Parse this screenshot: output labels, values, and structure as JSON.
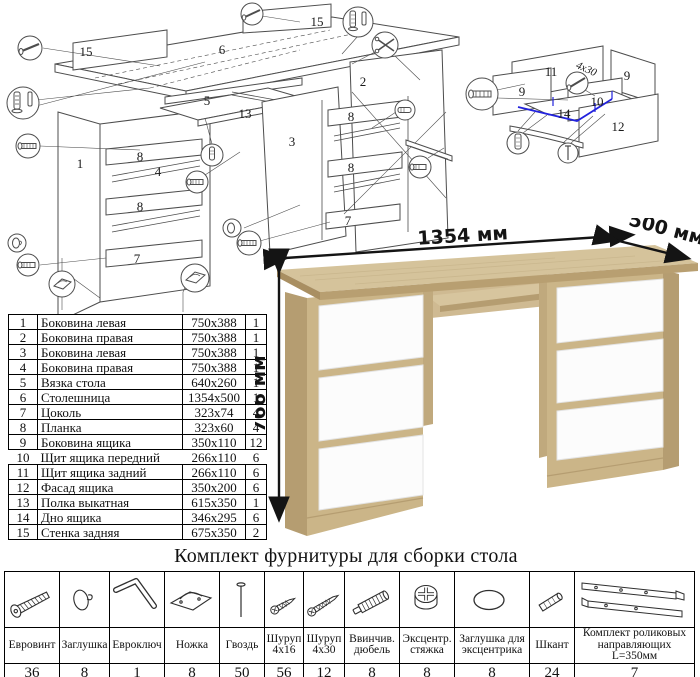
{
  "exploded": {
    "labels": [
      "15",
      "6",
      "15",
      "1",
      "8",
      "4",
      "8",
      "7",
      "5",
      "13",
      "3",
      "2",
      "8",
      "8",
      "7"
    ]
  },
  "drawer": {
    "labels": [
      "11",
      "9",
      "9",
      "10",
      "14",
      "12"
    ],
    "screw_note": "4x30",
    "highlight_color": "#2222dd"
  },
  "desk": {
    "dims": {
      "width": "1354 мм",
      "depth": "500 мм",
      "height": "766 мм"
    },
    "colors": {
      "oak_top": "#d5c39b",
      "oak_front": "#cbb588",
      "oak_side": "#b59d71",
      "drawer_white": "#fcfcfc"
    }
  },
  "parts_table": {
    "rows": [
      {
        "num": "1",
        "name": "Боковина левая",
        "size": "750x388",
        "qty": "1"
      },
      {
        "num": "2",
        "name": "Боковина правая",
        "size": "750x388",
        "qty": "1"
      },
      {
        "num": "3",
        "name": "Боковина левая",
        "size": "750x388",
        "qty": "1"
      },
      {
        "num": "4",
        "name": "Боковина правая",
        "size": "750x388",
        "qty": "1"
      },
      {
        "num": "5",
        "name": "Вязка стола",
        "size": "640x260",
        "qty": "1"
      },
      {
        "num": "6",
        "name": "Столешница",
        "size": "1354x500",
        "qty": "1"
      },
      {
        "num": "7",
        "name": "Цоколь",
        "size": "323x74",
        "qty": "4"
      },
      {
        "num": "8",
        "name": "Планка",
        "size": "323x60",
        "qty": "4"
      },
      {
        "num": "9",
        "name": "Боковина ящика",
        "size": "350x110",
        "qty": "12"
      },
      {
        "num": "10",
        "name": "Щит ящика передний",
        "size": "266x110",
        "qty": "6"
      },
      {
        "num": "11",
        "name": "Щит ящика задний",
        "size": "266x110",
        "qty": "6"
      },
      {
        "num": "12",
        "name": "Фасад ящика",
        "size": "350x200",
        "qty": "6"
      },
      {
        "num": "13",
        "name": "Полка выкатная",
        "size": "615x350",
        "qty": "1"
      },
      {
        "num": "14",
        "name": "Дно ящика",
        "size": "346x295",
        "qty": "6"
      },
      {
        "num": "15",
        "name": "Стенка задняя",
        "size": "675x350",
        "qty": "2"
      }
    ]
  },
  "hardware": {
    "title": "Комплект фурнитуры для сборки стола",
    "items": [
      {
        "icon": "euro-screw",
        "name": "Евровинт",
        "qty": "36"
      },
      {
        "icon": "cap",
        "name": "Заглушка",
        "qty": "8"
      },
      {
        "icon": "hex-key",
        "name": "Евроключ",
        "qty": "1"
      },
      {
        "icon": "foot",
        "name": "Ножка",
        "qty": "8"
      },
      {
        "icon": "nail",
        "name": "Гвоздь",
        "qty": "50"
      },
      {
        "icon": "screw",
        "name": "Шуруп 4x16",
        "qty": "56"
      },
      {
        "icon": "screw",
        "name": "Шуруп 4x30",
        "qty": "12"
      },
      {
        "icon": "dowel-screw",
        "name": "Ввинчив. дюбель",
        "qty": "8"
      },
      {
        "icon": "cam-lock",
        "name": "Эксцентр. стяжка",
        "qty": "8"
      },
      {
        "icon": "cover-cap",
        "name": "Заглушка для эксцентрика",
        "qty": "8"
      },
      {
        "icon": "dowel",
        "name": "Шкант",
        "qty": "24"
      },
      {
        "icon": "drawer-slides",
        "name": "Комплект роликовых направляющих L=350мм",
        "qty": "7"
      }
    ]
  }
}
